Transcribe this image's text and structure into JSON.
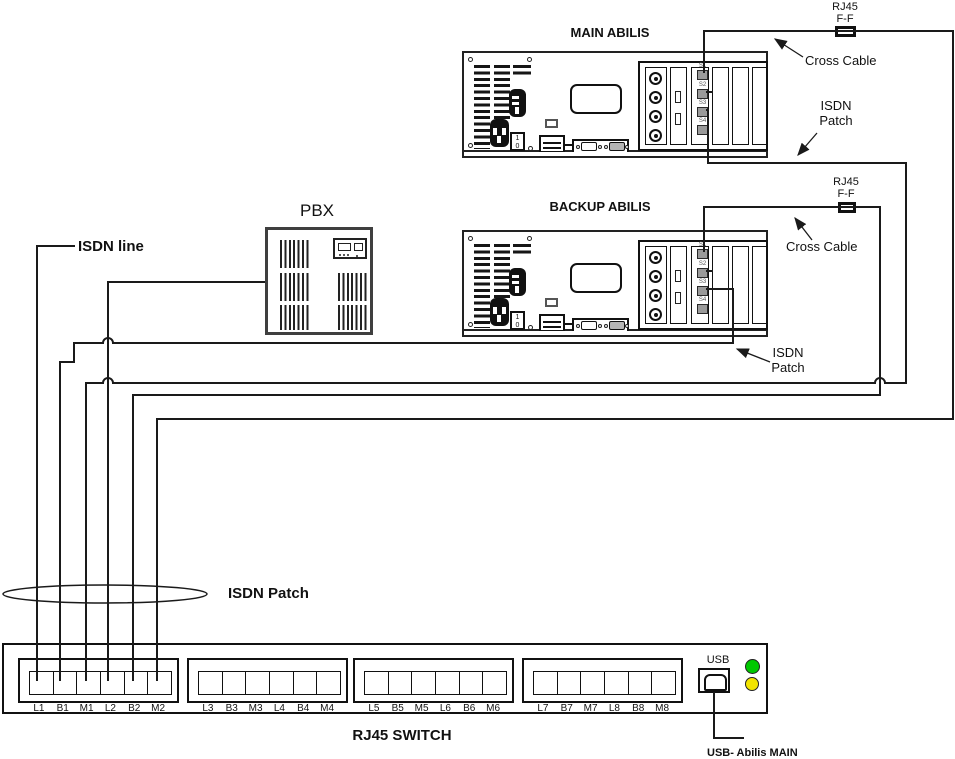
{
  "colors": {
    "line": "#1a1a1a",
    "led_green": "#00c800",
    "led_yellow": "#f2e400",
    "port_fill": "#9a9a9a"
  },
  "servers": [
    {
      "title": "MAIN ABILIS",
      "port_labels": [
        "S1",
        "S2",
        "S3",
        "S4"
      ],
      "power_switch": [
        "1",
        "0"
      ]
    },
    {
      "title": "BACKUP ABILIS",
      "port_labels": [
        "S1",
        "S2",
        "S3",
        "S4"
      ],
      "power_switch": [
        "1",
        "0"
      ]
    }
  ],
  "pbx": {
    "title": "PBX"
  },
  "rj45_switch": {
    "title": "RJ45 SWITCH",
    "port_groups": [
      [
        "L1",
        "B1",
        "M1",
        "L2",
        "B2",
        "M2"
      ],
      [
        "L3",
        "B3",
        "M3",
        "L4",
        "B4",
        "M4"
      ],
      [
        "L5",
        "B5",
        "M5",
        "L6",
        "B6",
        "M6"
      ],
      [
        "L7",
        "B7",
        "M7",
        "L8",
        "B8",
        "M8"
      ]
    ],
    "usb_label": "USB",
    "usb_cable_label": "USB- Abilis MAIN",
    "leds": [
      "green",
      "yellow"
    ]
  },
  "annotations": {
    "isdn_line": "ISDN line",
    "isdn_patch_bottom": "ISDN Patch",
    "rj45_ff_top": "RJ45\nF-F",
    "cross_cable_top": "Cross Cable",
    "isdn_patch_main": "ISDN\nPatch",
    "rj45_ff_mid": "RJ45\nF-F",
    "cross_cable_mid": "Cross Cable",
    "isdn_patch_backup": "ISDN\nPatch"
  },
  "wiring": {
    "cables": [
      {
        "name": "isdn-line-cable",
        "points": [
          [
            75,
            246
          ],
          [
            37,
            246
          ],
          [
            37,
            681
          ]
        ]
      },
      {
        "name": "pbx-to-switch-cable",
        "points": [
          [
            265,
            282
          ],
          [
            108,
            282
          ],
          [
            108,
            681
          ]
        ]
      },
      {
        "name": "backup-isdn-patch-cable",
        "points": [
          [
            706,
            289
          ],
          [
            733,
            289
          ],
          [
            733,
            343
          ],
          [
            74,
            343
          ],
          [
            74,
            362
          ],
          [
            60,
            362
          ],
          [
            60,
            681
          ]
        ]
      },
      {
        "name": "main-isdn-patch-cable",
        "points": [
          [
            706,
            110
          ],
          [
            708,
            110
          ],
          [
            708,
            163
          ],
          [
            906,
            163
          ],
          [
            906,
            383
          ],
          [
            86,
            383
          ],
          [
            86,
            681
          ]
        ]
      },
      {
        "name": "backup-cross-cable",
        "points": [
          [
            704,
            252
          ],
          [
            704,
            207
          ],
          [
            880,
            207
          ],
          [
            880,
            395
          ],
          [
            133,
            395
          ],
          [
            133,
            681
          ]
        ]
      },
      {
        "name": "main-cross-cable",
        "points": [
          [
            704,
            73
          ],
          [
            704,
            31
          ],
          [
            953,
            31
          ],
          [
            953,
            419
          ],
          [
            157,
            419
          ],
          [
            157,
            681
          ]
        ]
      },
      {
        "name": "usb-cable",
        "points": [
          [
            714,
            692
          ],
          [
            714,
            738
          ],
          [
            744,
            738
          ]
        ]
      },
      {
        "name": "main-s2-stub",
        "points": [
          [
            706,
            92
          ],
          [
            713,
            92
          ]
        ]
      },
      {
        "name": "backup-s2-stub",
        "points": [
          [
            706,
            271
          ],
          [
            713,
            271
          ]
        ]
      }
    ],
    "hops": [
      [
        108,
        343
      ],
      [
        108,
        383
      ],
      [
        880,
        383
      ]
    ],
    "arrows": [
      {
        "name": "cross-cable-top-arrow",
        "from": [
          803,
          57
        ],
        "to": [
          775,
          39
        ]
      },
      {
        "name": "isdn-patch-main-arrow",
        "from": [
          817,
          133
        ],
        "to": [
          798,
          155
        ]
      },
      {
        "name": "cross-cable-mid-arrow",
        "from": [
          812,
          240
        ],
        "to": [
          795,
          218
        ]
      },
      {
        "name": "isdn-patch-backup-arrow",
        "from": [
          770,
          362
        ],
        "to": [
          737,
          349
        ]
      }
    ],
    "ellipse": {
      "cx": 105,
      "cy": 594,
      "rx": 102,
      "ry": 9
    }
  }
}
